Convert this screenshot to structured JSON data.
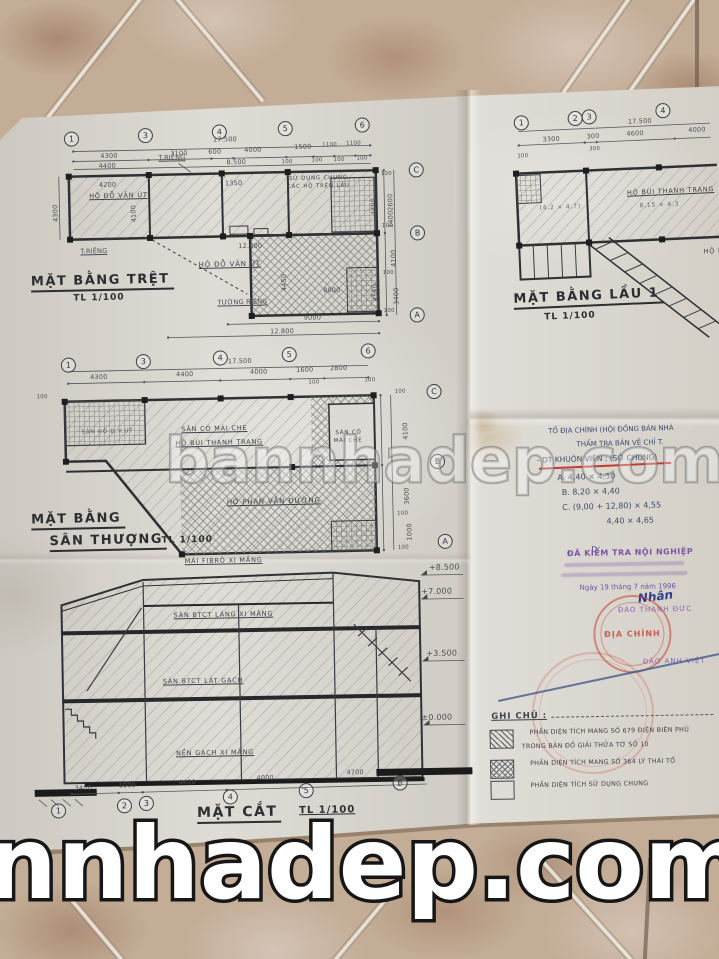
{
  "colors": {
    "paper": "#dbd8d1",
    "ink": "#3f4247",
    "stamp_red": "#c2483c",
    "stamp_purple": "#7d55a6",
    "pen_blue": "#3a4f8c"
  },
  "watermarks": {
    "center": "bannhadep.com",
    "bottom": "nnhadep.com"
  },
  "plans": {
    "ground": {
      "title": "MẶT BẰNG TRỆT",
      "scale": "TL 1/100",
      "grid_cols": [
        "1",
        "3",
        "4",
        "5",
        "6"
      ],
      "grid_rows": [
        "C",
        "B",
        "A"
      ],
      "dim_total": "17.500",
      "dims_top": [
        "4300",
        "3100",
        "600",
        "4000",
        "1500",
        "1100",
        "1100"
      ],
      "dims_top2": [
        "4400",
        "8.500",
        "100",
        "100",
        "100",
        "100"
      ],
      "dims_right": [
        "100",
        "2600",
        "1400",
        "100",
        "4100",
        "100",
        "3400",
        "100"
      ],
      "dims_right_inner": [
        "4400",
        "4550"
      ],
      "dims_left": [
        "4300"
      ],
      "dims_inner": [
        "4200",
        "4100",
        "1350",
        "12.600",
        "4450",
        "8800"
      ],
      "dims_bottom": [
        "9000",
        "12.800"
      ],
      "labels": {
        "wall_top": "T.RIÊNG",
        "wall_left": "T.RIÊNG",
        "wall_bottom": "TƯỜNG RIÊNG",
        "room1": "HỘ ĐỖ VĂN ÚT",
        "room2a": "SỬ DỤNG CHUNG",
        "room2b": "CÁC HỘ TRÊN LẦU",
        "room3": "HỘ ĐỖ VĂN ÚT"
      }
    },
    "floor1": {
      "title": "MẶT BẰNG LẦU 1",
      "scale": "TL 1/100",
      "grid_cols": [
        "1",
        "2",
        "3",
        "4"
      ],
      "dim_total": "17.500",
      "dims_top": [
        "3300",
        "300",
        "4600",
        "4000"
      ],
      "dims_small": [
        "100",
        "300"
      ],
      "labels": {
        "room1": "HỘ BÙI THANH TRANG",
        "room1_size": "8,15 × 4,3",
        "room2_size": "(4,2 × 4,7)",
        "room3": "HỘ P"
      }
    },
    "roof": {
      "title": "MẶT BẰNG",
      "title2": "SÂN THƯỢNG",
      "scale": "TL 1/100",
      "grid_cols": [
        "1",
        "3",
        "4",
        "5",
        "6"
      ],
      "grid_rows": [
        "C",
        "B",
        "A"
      ],
      "dim_total": "17.500",
      "dims_top": [
        "4300",
        "4400",
        "4000",
        "1600",
        "2800"
      ],
      "dims_small": [
        "100",
        "100",
        "100"
      ],
      "dims_right": [
        "100",
        "4100",
        "3600",
        "100",
        "1000",
        "100"
      ],
      "labels": {
        "area1": "SÂN CÓ MÁI CHE",
        "area1b": "HỘ BÙI THANH TRANG",
        "area2a": "SÂN CÓ",
        "area2b": "MÁI CHE",
        "area3": "HỘ PHAN VĂN ĐƯỜNG",
        "area4": "SÂN HỘ Đ.V.ÚT"
      }
    },
    "section": {
      "title": "MẶT CẮT",
      "scale": "TL 1/100",
      "grid_cols": [
        "1",
        "2",
        "3",
        "4",
        "5",
        "6"
      ],
      "dims_bottom": [
        "3400",
        "1000",
        "4400",
        "4000",
        "4700"
      ],
      "elevations": [
        "+8.500",
        "+7.000",
        "+3.500",
        "±0.000"
      ],
      "labels": {
        "roof": "MÁI FIBRÔ XI MĂNG",
        "slab2": "SÀN BTCT LÁNG XI MĂNG",
        "slab1": "SÀN BTCT LÁT GẠCH",
        "ground": "NỀN GẠCH XI MĂNG"
      }
    }
  },
  "notes": {
    "line1": "TỔ ĐỊA CHÍNH (HỘI ĐỒNG BÁN NHÀ",
    "line2": "THẨM TRA BẢN VẼ CHỈ T.",
    "line3": "- DT KHUÔN VIÊN : (SỞ CHUNG)",
    "item_a": "A.   4,40 × 4,30",
    "item_b": "B.   8,20 × 4,40",
    "item_c": "C.   (9,00 + 12,80) × 4,55",
    "item_c2": "4,40 × 4,65",
    "item_d": "D."
  },
  "stamps": {
    "check_title": "ĐÃ KIỂM TRA NỘI NGHIỆP",
    "check_date": "Ngày 19 tháng 7 năm 1996",
    "check_sign": "Nhân",
    "check_name": "ĐÀO THANH ĐỨC",
    "round_text": "ĐỊA CHÍNH",
    "name2": "ĐÀO ANH VIỆT"
  },
  "legend": {
    "title": "GHI CHÚ :",
    "item1a": "PHẦN DIỆN TÍCH MANG SỐ 679 ĐIỆN BIÊN PHỦ",
    "item1b": "TRONG BẢN ĐỒ GIẢI THỬA TỜ SỐ 10",
    "item2": "PHẦN DIỆN TÍCH MANG SỐ 364 LÝ THÁI TỔ",
    "item3": "PHẦN DIỆN TÍCH SỬ DỤNG CHUNG"
  }
}
